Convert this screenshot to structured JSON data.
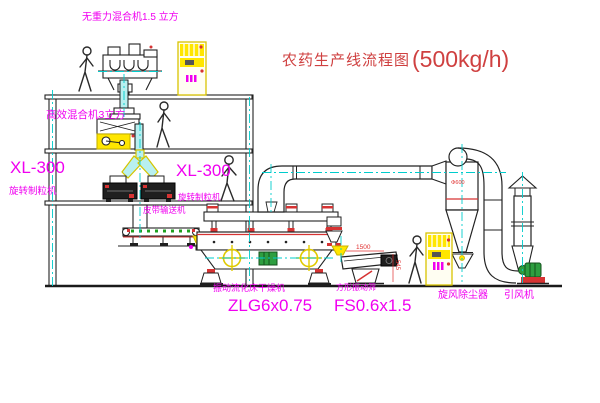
{
  "title": {
    "text": "农药生产线流程图",
    "capacity": "(500kg/h)"
  },
  "labels": {
    "gravity_mixer": "无重力混合机1.5 立方",
    "high_mixer": "高效混合机3立方",
    "granulator_left_model": "XL-300",
    "granulator_left_name": "旋转制粒机",
    "granulator_center_model": "XL-300",
    "granulator_center_name": "旋转制粒机",
    "belt_conveyor": "皮带输送机",
    "dryer_name": "振动流化床干燥机",
    "dryer_model": "ZLG6x0.75",
    "screen_name": "方形振动筛",
    "screen_model": "FS0.6x1.5",
    "cyclone": "旋风除尘器",
    "fan": "引风机"
  },
  "dimensions": {
    "screen_length": "1500",
    "screen_height": "545",
    "cyclone_dia": "Φ600"
  },
  "colors": {
    "label_magenta": "#f000f0",
    "title_red": "#cf4040",
    "dimension_red": "#e03030",
    "machine_yellow": "#ffe600",
    "centerline_cyan": "#00cccc",
    "motor_green": "#2e9e40"
  }
}
